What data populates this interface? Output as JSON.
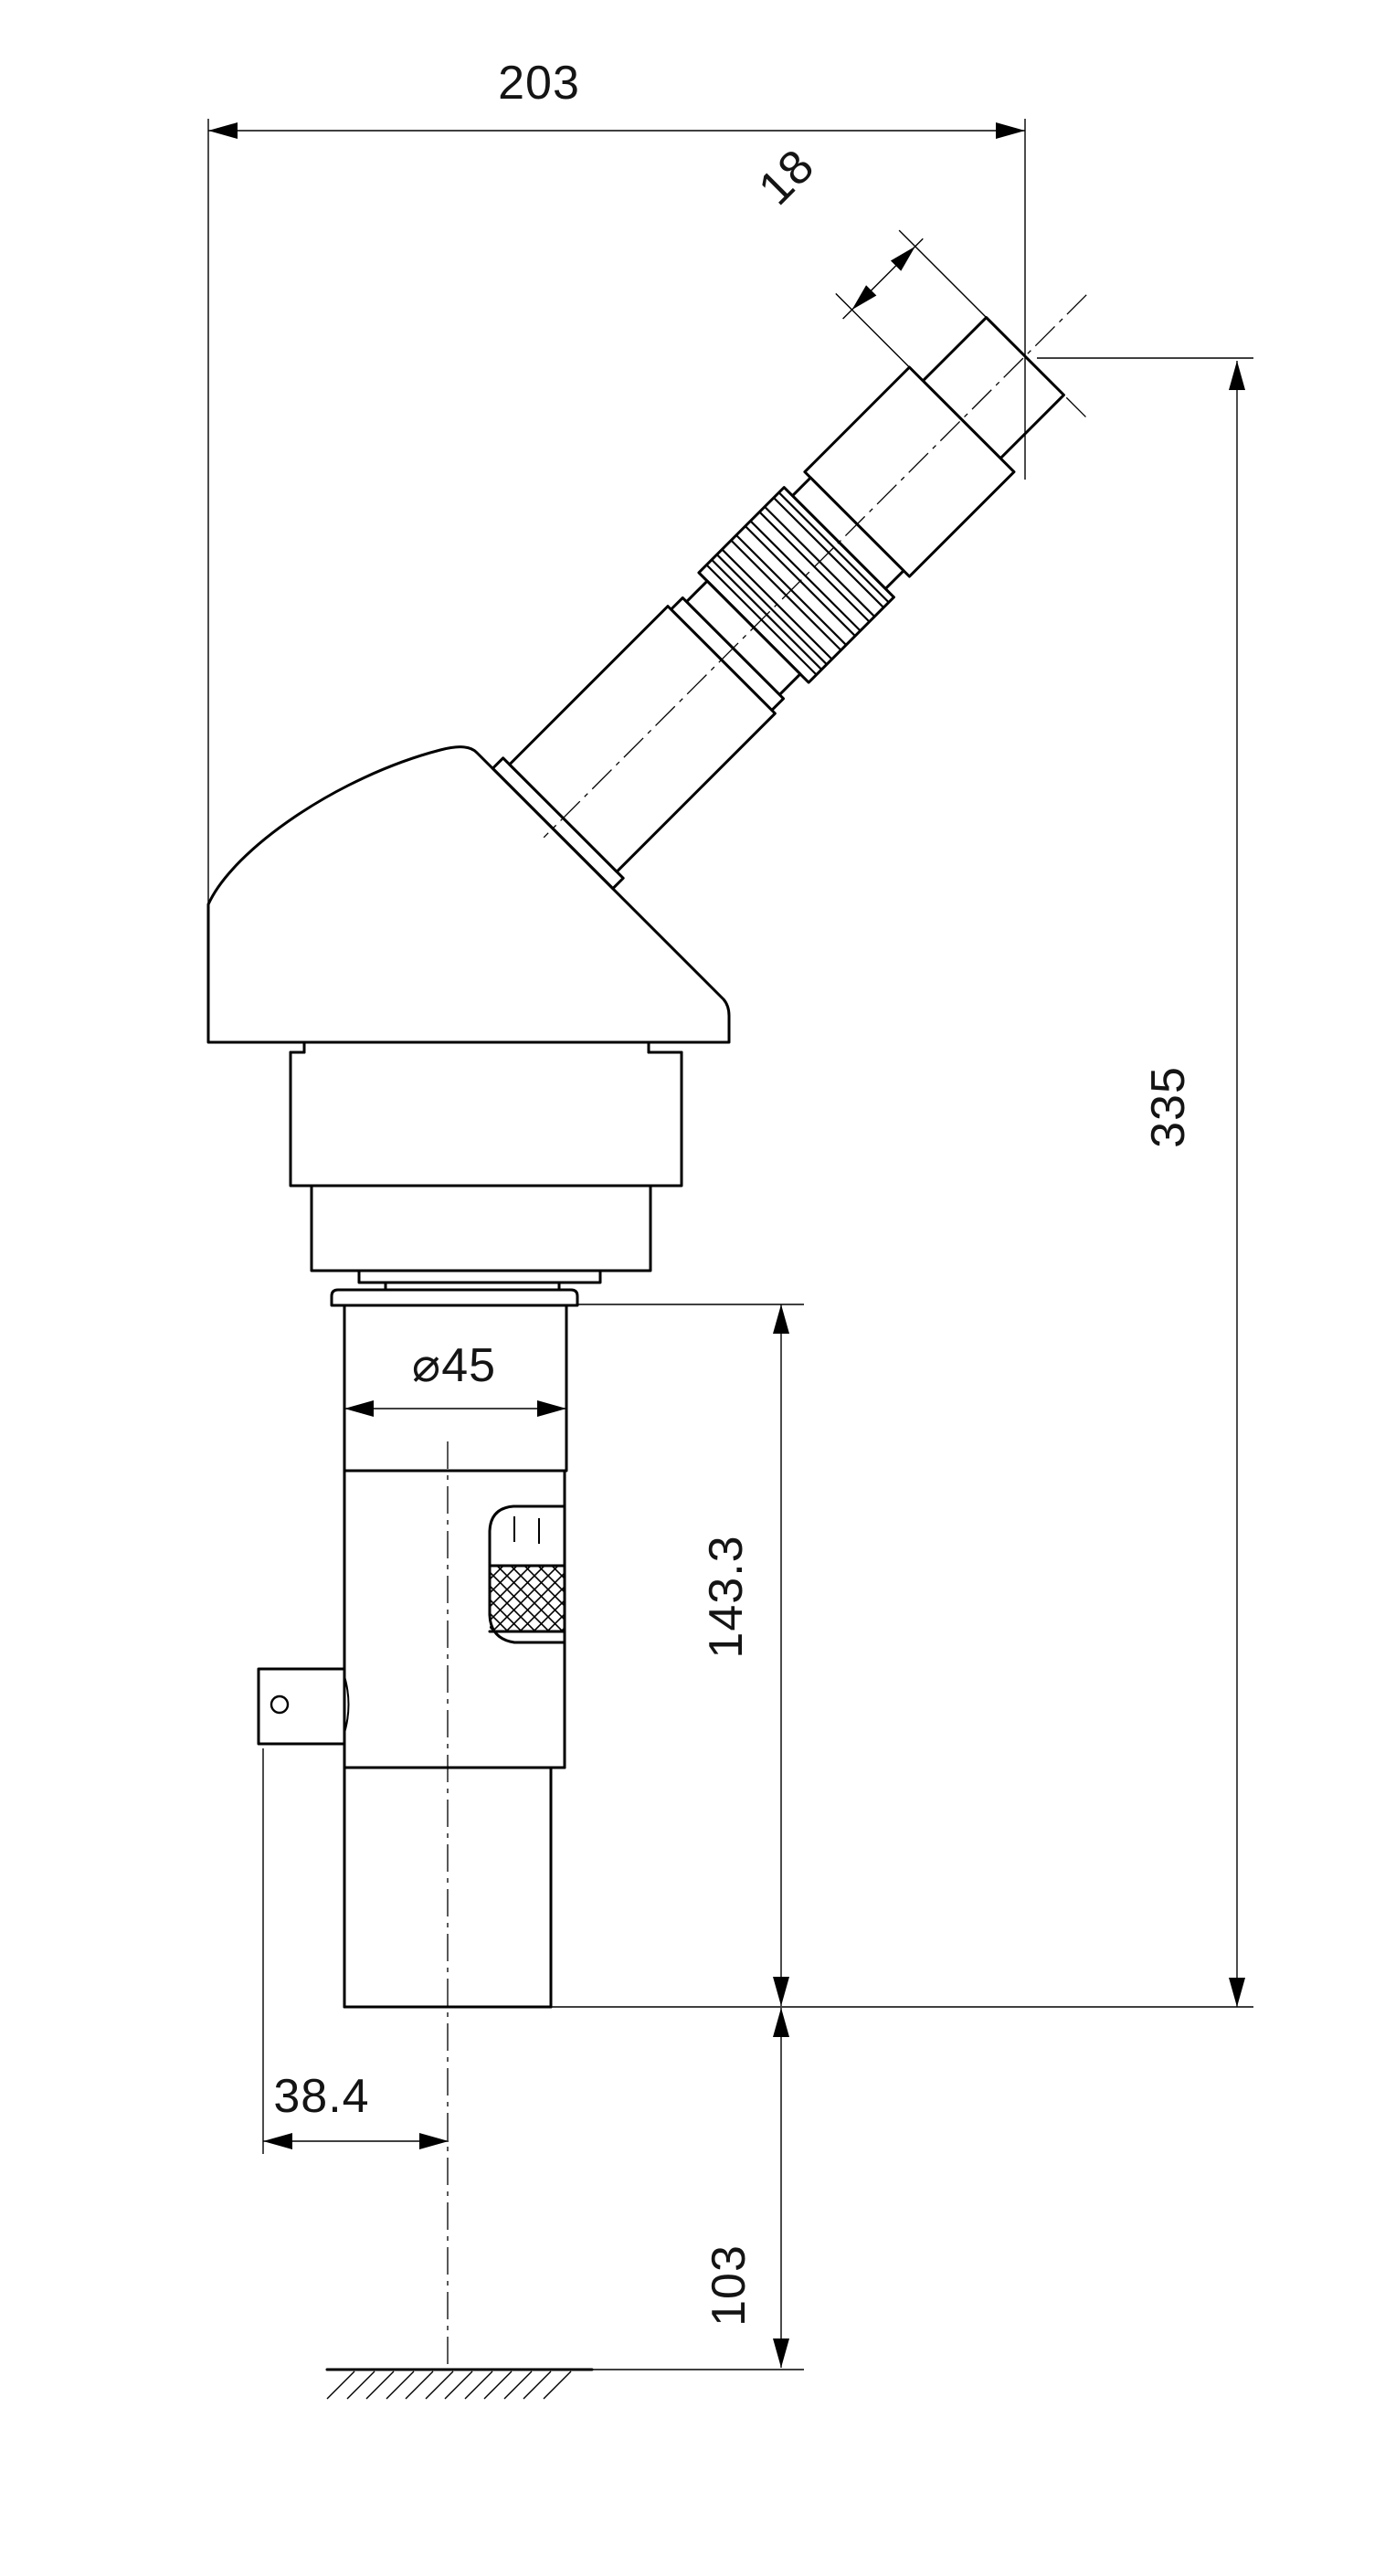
{
  "drawing": {
    "background_color": "#ffffff",
    "line_color": "#000000",
    "dimensions": {
      "total_width": "203",
      "eyepiece_end_length": "18",
      "overall_height": "335",
      "tube_diameter": "⌀45",
      "body_height": "143.3",
      "axis_offset": "38.4",
      "ground_clearance": "103"
    }
  }
}
